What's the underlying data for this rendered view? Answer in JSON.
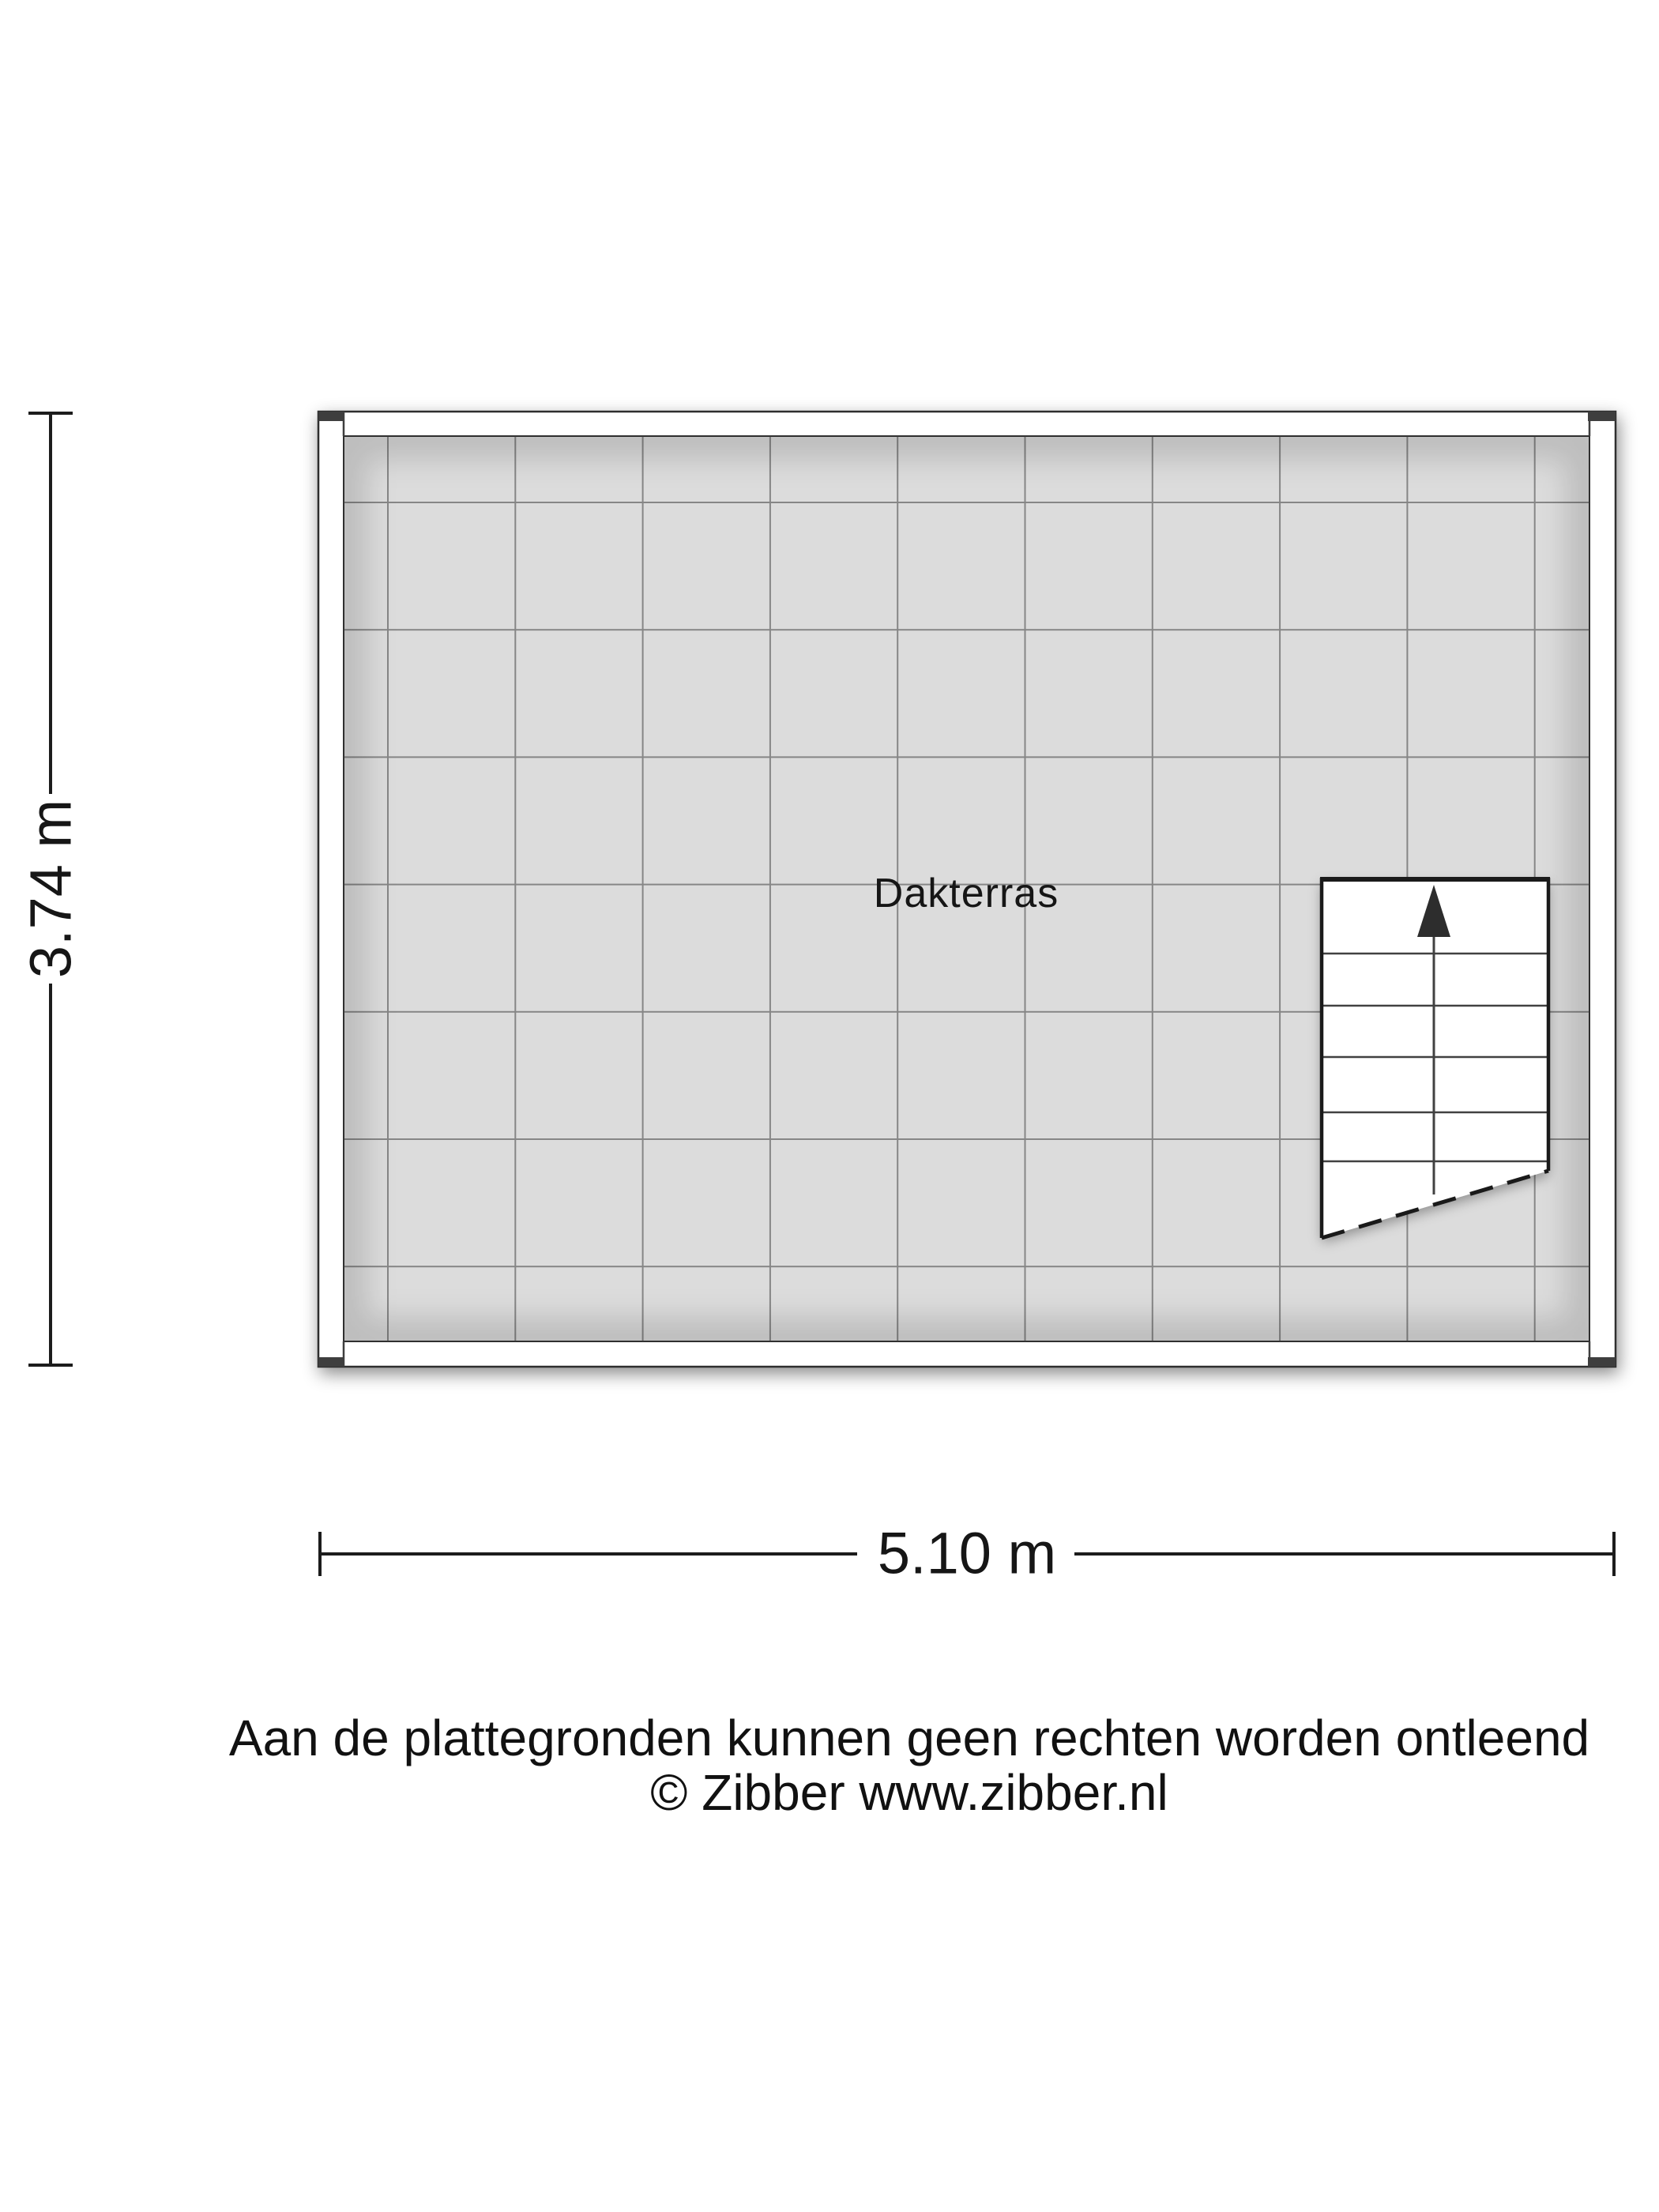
{
  "floorplan": {
    "room_label": "Dakterras",
    "width_dimension": "5.10 m",
    "height_dimension": "3.74 m",
    "floor_color": "#dcdcdc",
    "wall_fill": "#ffffff",
    "outline_color": "#2f2f2f",
    "grid_line_color": "#3f3f3f",
    "stair_edge_color": "#1a1a1a",
    "dimension_line_color": "#1c1c1c"
  },
  "footer": {
    "line1": "Aan de plattegronden kunnen geen rechten worden ontleend",
    "line2": "© Zibber www.zibber.nl"
  }
}
